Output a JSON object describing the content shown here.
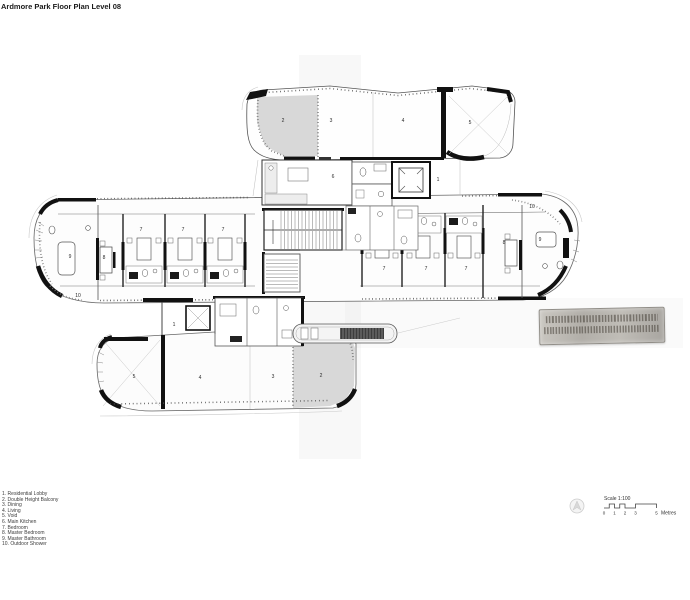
{
  "header": {
    "title": "Ardmore Park Floor Plan Level 08"
  },
  "legend": {
    "items": [
      "1. Residential Lobby",
      "2. Double Height Balcony",
      "3. Dining",
      "4. Living",
      "5. Void",
      "6. Main Kitchen",
      "7. Bedroom",
      "8. Master Bedroom",
      "9. Master Bathroom",
      "10. Outdoor Shower"
    ]
  },
  "scale": {
    "title": "Scale 1:100",
    "ticks": [
      "0",
      "1",
      "2",
      "3",
      "5"
    ],
    "unit": "Metres"
  },
  "stamp": {
    "legible": false,
    "line_count": 2,
    "description": "illegible embossed architect stamp plaque"
  },
  "icons": {
    "north": "compass-circle-icon"
  },
  "plan": {
    "shade_color": "#d8d8d8",
    "wall_color": "#111111",
    "labels": [
      "2",
      "3",
      "4",
      "5",
      "6",
      "1",
      "9",
      "8",
      "7",
      "7",
      "7",
      "10",
      "7",
      "7",
      "7",
      "8",
      "9",
      "10",
      "1",
      "5",
      "4",
      "3",
      "2"
    ]
  }
}
